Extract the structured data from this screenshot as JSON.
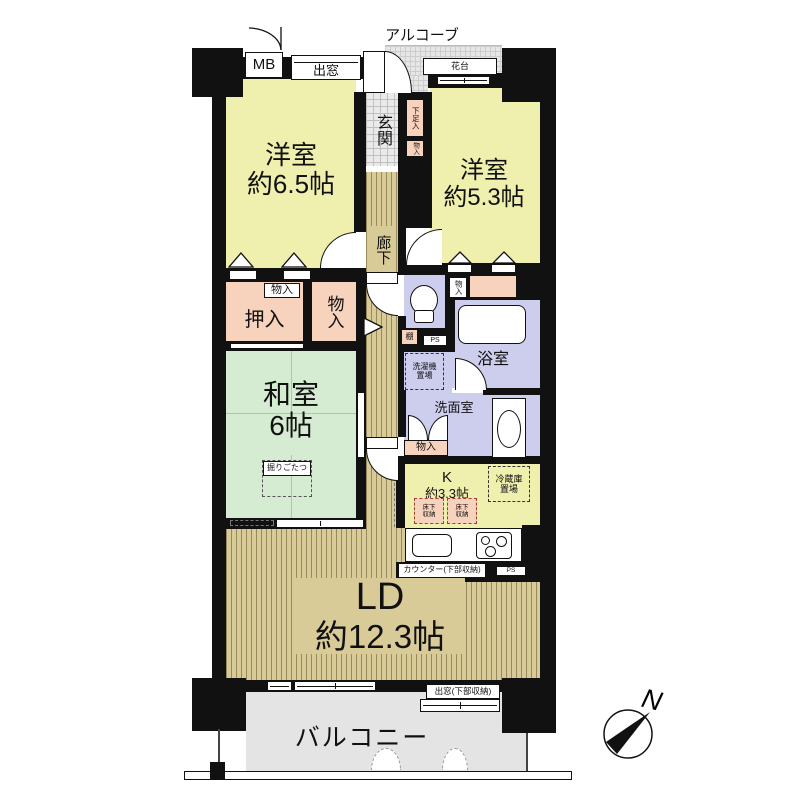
{
  "labels": {
    "alcove": "アルコーブ",
    "mb": "MB",
    "bay_window_top": "出窓",
    "flower_stand": "花台",
    "entrance": "玄関",
    "shoe_cabinet": "下足入",
    "entrance_storage": "物入",
    "western_room_1_name": "洋室",
    "western_room_1_size": "約6.5帖",
    "western_room_2_name": "洋室",
    "western_room_2_size": "約5.3帖",
    "corridor": "廊下",
    "closet_small": "物入",
    "oshiire": "押入",
    "closet_tall": "物入",
    "japanese_room_name": "和室",
    "japanese_room_size": "6帖",
    "kotatsu": "掘りごたつ",
    "shelf": "棚",
    "ps_upper": "PS",
    "closet_wr2": "物入",
    "bathroom": "浴室",
    "washer_line1": "洗濯機",
    "washer_line2": "置場",
    "washroom": "洗面室",
    "closet_washroom": "物入",
    "kitchen_name": "K",
    "kitchen_size": "約3.3帖",
    "fridge_line1": "冷蔵庫",
    "fridge_line2": "置場",
    "underfloor_line1": "床下",
    "underfloor_line2": "収納",
    "counter": "カウンター(下部収納)",
    "ps_lower": "PS",
    "living_name": "LD",
    "living_size": "約12.3帖",
    "bay_window_bottom": "出窓(下部収納)",
    "balcony": "バルコニー",
    "compass_north": "N"
  },
  "colors": {
    "wall": "#111111",
    "western_room": "#f0f0ae",
    "japanese_room": "#d6ecd2",
    "storage": "#f7d2bd",
    "wet_area": "#cdcdee",
    "wood_floor": "#d9cb97",
    "balcony": "#e4e4e4"
  }
}
